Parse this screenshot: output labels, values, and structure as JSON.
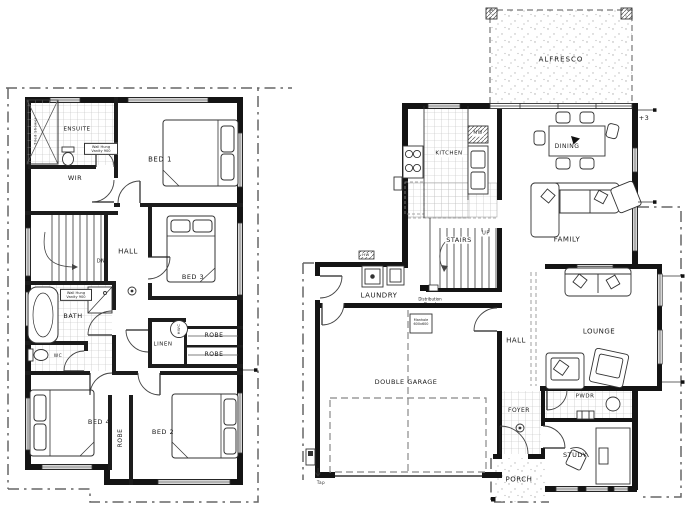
{
  "drawing": {
    "type": "two-storey residential floor plan",
    "sheets": [
      "upper floor plan",
      "ground floor plan"
    ]
  },
  "upper_floor": {
    "rooms": {
      "ensuite": "ENSUITE",
      "wir": "WIR",
      "bed1": "BED 1",
      "hall": "HALL",
      "bed3": "BED 3",
      "bath": "BATH",
      "wc": "WC",
      "linen": "LINEN",
      "robe_a": "ROBE",
      "robe_b": "ROBE",
      "robe_c": "ROBE",
      "bed4": "BED 4",
      "bed2": "BED 2"
    },
    "annotations": {
      "down": "DN",
      "hot_water": "HWC",
      "ensuite_vanity": "Wall Hung Vanity 900",
      "bath_vanity": "Wall Hung Vanity 900",
      "shower": "Tiled Shower"
    }
  },
  "ground_floor": {
    "rooms": {
      "alfresco": "ALFRESCO",
      "kitchen": "KITCHEN",
      "dining": "DINING",
      "family": "FAMILY",
      "stairs": "STAIRS",
      "laundry": "LAUNDRY",
      "hall": "HALL",
      "lounge": "LOUNGE",
      "garage": "DOUBLE GARAGE",
      "foyer": "FOYER",
      "pwdr": "PWDR",
      "study": "STUDY",
      "porch": "PORCH"
    },
    "annotations": {
      "up": "UP",
      "microwave": "MW",
      "hot_water": "HW",
      "tap": "Tap",
      "distribution_board": "Distribution Board",
      "manhole": "Manhole 600x600",
      "level": "+3"
    }
  },
  "colors": {
    "wall": "#141414",
    "line": "#333333",
    "boundary": "#666666",
    "tile_grid": "#bbbbbb",
    "background": "#ffffff"
  }
}
